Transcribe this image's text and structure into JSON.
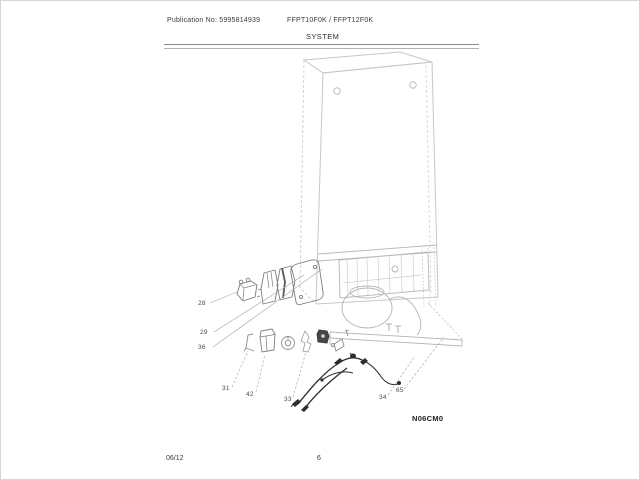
{
  "page": {
    "header": {
      "publication": "Publication No: 5995814939",
      "models": "FFPT10F0K / FFPT12F0K",
      "section_title": "SYSTEM"
    },
    "diagram": {
      "figure_code": "N06CM0",
      "description": "Exploded parts diagram of refrigerator system: cabinet, machine compartment with compressor, relay, start device, cover, bracket, grommet, nut and wiring harness",
      "callouts": [
        {
          "label": "28"
        },
        {
          "label": "29"
        },
        {
          "label": "36"
        },
        {
          "label": "31"
        },
        {
          "label": "42"
        },
        {
          "label": "33"
        },
        {
          "label": "34"
        },
        {
          "label": "65"
        }
      ]
    },
    "footer": {
      "revision_date": "06/12",
      "page_number": "6"
    },
    "colors": {
      "sketch_light": "#c4c4c4",
      "sketch_mid": "#b2b2b2",
      "part_outline": "#7d7d7d",
      "part_dark": "#474747",
      "harness": "#2e2e2e",
      "text": "#2e2e2e"
    }
  }
}
